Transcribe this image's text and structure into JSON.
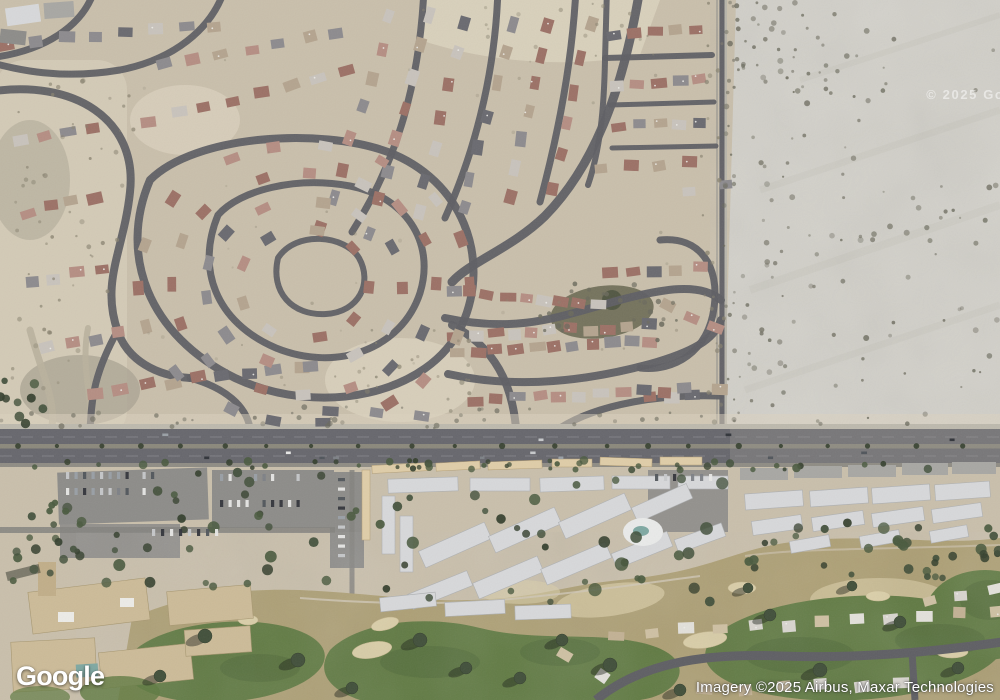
{
  "ui": {
    "logo": "Google",
    "attribution": "Imagery ©2025 Airbus, Maxar Technologies",
    "watermark": "© 2025 Goo",
    "view_mode": "satellite"
  },
  "palette": {
    "ground": "#c9bfaa",
    "ground_light": "#dbd2bd",
    "scrub": "#a9a392",
    "basin": "#66654f",
    "desert": "#d2d0c9",
    "desert_streak": "#c3c1b8",
    "desert_edge": "#b5b2a8",
    "street": "#5f5f64",
    "dirt": "#b9b19c",
    "sidewalk": "#bdb9ad",
    "asphalt": "#67676d",
    "asphalt_light": "#97968f",
    "median": "#8b887b",
    "lane": "#9a999f",
    "road_edge": "#8f8c84",
    "lot": "#8d8c89",
    "drive": "#84837f",
    "carport": "#e0cda6",
    "carport_stroke": "#b49e74",
    "condo": "#d7d8da",
    "condo_stroke": "#aeb0b2",
    "garage": "#a8a7a3",
    "resort": "#cdbb97",
    "resort_stroke": "#a8976f",
    "tower": "#c2ae87",
    "pool": "#7ea8a2",
    "pool_deck": "#e9eae9",
    "rough": "#ae9f72",
    "fairway": "#5f7a40",
    "fairway_dark": "#4e6735",
    "bunker": "#dbcfa7",
    "bunker_stroke": "#c9b98e",
    "cart_path": "#cfc7b4",
    "tree": "#42503a",
    "tree_dark": "#35402d",
    "tree_mid": "#4a5a3e",
    "shadow": "rgba(30,36,26,0.45)",
    "shrub": "#8a8470",
    "shrub_dark": "#6b6a5c",
    "white_dot": "#ecebe7",
    "roofs": [
      "#9d7165",
      "#b68e82",
      "#8d8b8e",
      "#6a6a70",
      "#b5a48e",
      "#c8c3bc"
    ],
    "villas": [
      "#d8d5cf",
      "#cfc0a2",
      "#c3b193",
      "#e2e0da"
    ],
    "cars": [
      "#e8e8e6",
      "#50555b",
      "#9aa0a6",
      "#c7c9cb",
      "#31343a",
      "#7d8186"
    ]
  },
  "scene": {
    "streets": [
      {
        "d": "M 640,-12 C 625,80 598,162 545,216 C 512,248 470,262 452,282",
        "w": 9
      },
      {
        "d": "M 150,180 C 118,255 148,335 235,378 C 320,418 430,395 462,325 C 492,258 462,180 388,152 C 320,127 195,135 150,180 Z",
        "w": 8
      },
      {
        "d": "M 218,215 C 196,268 215,322 276,348 C 338,373 402,348 420,293 C 436,241 404,196 350,186 C 296,176 240,190 218,215 Z",
        "w": 7
      },
      {
        "d": "M 278,258 C 270,292 292,316 326,314 C 359,312 373,283 359,258 C 345,235 296,230 278,258 Z",
        "w": 6
      },
      {
        "d": "M 452,325 C 496,348 512,385 516,428",
        "w": 8
      },
      {
        "d": "M -12,92 C 75,78 138,120 130,192 C 124,250 100,282 118,332 C 128,360 156,376 190,378",
        "w": 8
      },
      {
        "d": "M 190,378 C 226,388 246,406 250,428",
        "w": 7
      },
      {
        "d": "M 118,330 C 90,380 92,408 90,428",
        "w": 7
      },
      {
        "d": "M 225,-12 C 212,30 172,60 120,70 C 60,80 20,70 -12,62",
        "w": 7
      },
      {
        "d": "M 95,-12 C 84,26 44,52 -12,58",
        "w": 7
      },
      {
        "d": "M 352,232 C 398,160 420,80 424,-12",
        "w": 7
      },
      {
        "d": "M 445,218 C 480,140 496,60 498,-12",
        "w": 7
      },
      {
        "d": "M 540,202 C 562,120 573,50 576,-12",
        "w": 7
      },
      {
        "d": "M 607,-12 L 605,60 C 604,110 600,150 588,185",
        "w": 6
      },
      {
        "d": "M 605,58 L 712,55",
        "w": 6
      },
      {
        "d": "M 610,105 L 714,102",
        "w": 5
      },
      {
        "d": "M 612,148 L 716,146",
        "w": 5
      },
      {
        "d": "M 722,-12 L 722,428",
        "w": 5
      },
      {
        "d": "M 660,240 C 700,236 720,266 714,308 C 708,352 674,372 640,368",
        "w": 7
      },
      {
        "d": "M 445,318 C 520,334 560,316 620,300 C 662,289 700,282 721,300",
        "w": 8
      },
      {
        "d": "M 448,374 C 520,390 590,380 650,364 C 692,352 714,340 721,320",
        "w": 8
      },
      {
        "d": "M 560,428 C 598,404 660,394 720,396",
        "w": 7
      }
    ],
    "dirt_paths": [
      {
        "d": "M 30,330 C 40,368 56,400 52,426",
        "w": 7
      },
      {
        "d": "M 88,328 C 80,368 94,404 90,426",
        "w": 6
      }
    ],
    "house_rows": [
      [
        8,
        44,
        215,
        26,
        8
      ],
      [
        150,
        120,
        345,
        72,
        8
      ],
      [
        164,
        64,
        338,
        32,
        7
      ],
      [
        22,
        142,
        92,
        128,
        4
      ],
      [
        26,
        212,
        96,
        198,
        4
      ],
      [
        32,
        282,
        102,
        268,
        4
      ],
      [
        48,
        348,
        118,
        334,
        4
      ],
      [
        322,
        228,
        390,
        18,
        8
      ],
      [
        370,
        232,
        430,
        16,
        8
      ],
      [
        418,
        214,
        466,
        22,
        7
      ],
      [
        463,
        208,
        512,
        24,
        7
      ],
      [
        510,
        196,
        549,
        28,
        7
      ],
      [
        553,
        188,
        590,
        26,
        6
      ],
      [
        616,
        35,
        696,
        31,
        5
      ],
      [
        618,
        84,
        700,
        80,
        5
      ],
      [
        620,
        126,
        702,
        122,
        5
      ],
      [
        602,
        168,
        688,
        162,
        4
      ],
      [
        690,
        192,
        724,
        186,
        2
      ],
      [
        668,
        306,
        714,
        326,
        3
      ],
      [
        648,
        398,
        718,
        392,
        4
      ],
      [
        452,
        290,
        598,
        304,
        9
      ],
      [
        610,
        274,
        700,
        268,
        5
      ],
      [
        455,
        336,
        648,
        326,
        11
      ],
      [
        458,
        352,
        652,
        342,
        11
      ],
      [
        476,
        400,
        686,
        390,
        11
      ],
      [
        96,
        392,
        300,
        366,
        9
      ],
      [
        330,
        412,
        420,
        416,
        3
      ]
    ],
    "villa_rows": [
      [
        618,
        634,
        995,
        612,
        12
      ],
      [
        928,
        600,
        995,
        589,
        3
      ],
      [
        566,
        656,
        600,
        678,
        2
      ],
      [
        705,
        689,
        900,
        684,
        6
      ]
    ],
    "spiral": {
      "cx": 304,
      "cy": 284,
      "rings": [
        [
          58,
          9
        ],
        [
          88,
          13
        ],
        [
          118,
          16
        ],
        [
          148,
          18
        ]
      ]
    },
    "shrub_areas": [
      {
        "x": 724,
        "y": 0,
        "w": 276,
        "h": 424,
        "n": 150,
        "r0": 1,
        "r1": 3,
        "c": "shrub_dark",
        "o0": 0.35,
        "o1": 0.8,
        "bias": 1.9
      },
      {
        "x": 730,
        "y": 0,
        "w": 120,
        "h": 95,
        "n": 28,
        "r0": 1.2,
        "r1": 3,
        "c": "shrub_dark",
        "o0": 0.4,
        "o1": 0.85,
        "bias": 1.4
      },
      {
        "x": 700,
        "y": 0,
        "w": 24,
        "h": 420,
        "n": 22,
        "r0": 1,
        "r1": 2.5,
        "c": "shrub",
        "o0": 0.4,
        "o1": 0.8,
        "bias": 1
      },
      {
        "x": 0,
        "y": 60,
        "w": 135,
        "h": 360,
        "n": 55,
        "r0": 1,
        "r1": 2.6,
        "c": "shrub",
        "o0": 0.4,
        "o1": 0.8,
        "bias": 1
      },
      {
        "x": 540,
        "y": 282,
        "w": 140,
        "h": 62,
        "n": 26,
        "r0": 1.2,
        "r1": 3,
        "c": "shrub_dark",
        "o0": 0.5,
        "o1": 0.9,
        "bias": 1
      },
      {
        "x": 400,
        "y": 0,
        "w": 260,
        "h": 58,
        "n": 18,
        "r0": 1,
        "r1": 2.4,
        "c": "shrub",
        "o0": 0.3,
        "o1": 0.6,
        "bias": 1
      },
      {
        "x": 0,
        "y": 406,
        "w": 724,
        "h": 22,
        "n": 42,
        "r0": 1.2,
        "r1": 3,
        "c": "shrub_dark",
        "o0": 0.35,
        "o1": 0.7,
        "bias": 1
      },
      {
        "x": 330,
        "y": 330,
        "w": 140,
        "h": 86,
        "n": 22,
        "r0": 1,
        "r1": 2.6,
        "c": "shrub",
        "o0": 0.4,
        "o1": 0.75,
        "bias": 1
      },
      {
        "x": 140,
        "y": 60,
        "w": 540,
        "h": 330,
        "n": 40,
        "r0": 1,
        "r1": 2,
        "c": "shrub",
        "o0": 0.2,
        "o1": 0.45,
        "bias": 1
      }
    ],
    "tree_areas": [
      {
        "x": 0,
        "y": 460,
        "w": 1000,
        "h": 10,
        "n": 48,
        "r0": 2,
        "r1": 4.5
      },
      {
        "x": 345,
        "y": 475,
        "w": 385,
        "h": 140,
        "n": 36,
        "r0": 3,
        "r1": 7
      },
      {
        "x": 735,
        "y": 522,
        "w": 265,
        "h": 52,
        "n": 22,
        "r0": 3,
        "r1": 6
      },
      {
        "x": 12,
        "y": 500,
        "w": 70,
        "h": 85,
        "n": 22,
        "r0": 3,
        "r1": 5
      },
      {
        "x": 150,
        "y": 470,
        "w": 180,
        "h": 60,
        "n": 14,
        "r0": 3,
        "r1": 6
      },
      {
        "x": 85,
        "y": 532,
        "w": 245,
        "h": 55,
        "n": 14,
        "r0": 3,
        "r1": 6
      },
      {
        "x": 0,
        "y": 380,
        "w": 45,
        "h": 48,
        "n": 9,
        "r0": 3,
        "r1": 5
      },
      {
        "x": 838,
        "y": 540,
        "w": 162,
        "h": 38,
        "n": 12,
        "r0": 3,
        "r1": 5
      }
    ],
    "golf_trees": [
      [
        205,
        636,
        7
      ],
      [
        160,
        676,
        6
      ],
      [
        298,
        660,
        7
      ],
      [
        352,
        688,
        6
      ],
      [
        420,
        640,
        7
      ],
      [
        466,
        668,
        6
      ],
      [
        520,
        678,
        6
      ],
      [
        562,
        640,
        6
      ],
      [
        610,
        665,
        7
      ],
      [
        680,
        690,
        6
      ],
      [
        770,
        615,
        6
      ],
      [
        820,
        670,
        7
      ],
      [
        900,
        622,
        6
      ],
      [
        958,
        668,
        6
      ],
      [
        748,
        588,
        5
      ],
      [
        852,
        586,
        5
      ]
    ],
    "car_rows": [
      {
        "x": 66,
        "y": 472,
        "n": 11,
        "dx": 8.5,
        "dy": 0,
        "w": 3.2,
        "h": 7
      },
      {
        "x": 66,
        "y": 488,
        "n": 11,
        "dx": 8.5,
        "dy": 0,
        "w": 3.2,
        "h": 7
      },
      {
        "x": 220,
        "y": 474,
        "n": 10,
        "dx": 8.5,
        "dy": 0,
        "w": 3.2,
        "h": 7
      },
      {
        "x": 220,
        "y": 500,
        "n": 10,
        "dx": 8.5,
        "dy": 0,
        "w": 3.2,
        "h": 7
      },
      {
        "x": 655,
        "y": 474,
        "n": 7,
        "dx": 9,
        "dy": 0,
        "w": 3.2,
        "h": 7
      },
      {
        "x": 338,
        "y": 478,
        "n": 9,
        "dx": 0,
        "dy": 9.5,
        "w": 7,
        "h": 3.2
      },
      {
        "x": 152,
        "y": 529,
        "n": 8,
        "dx": 9,
        "dy": 0,
        "w": 3.2,
        "h": 7
      }
    ],
    "arterial_cars": 13,
    "median_trees": {
      "y": 446,
      "x0": 18,
      "x1": 995,
      "step": 46
    }
  }
}
